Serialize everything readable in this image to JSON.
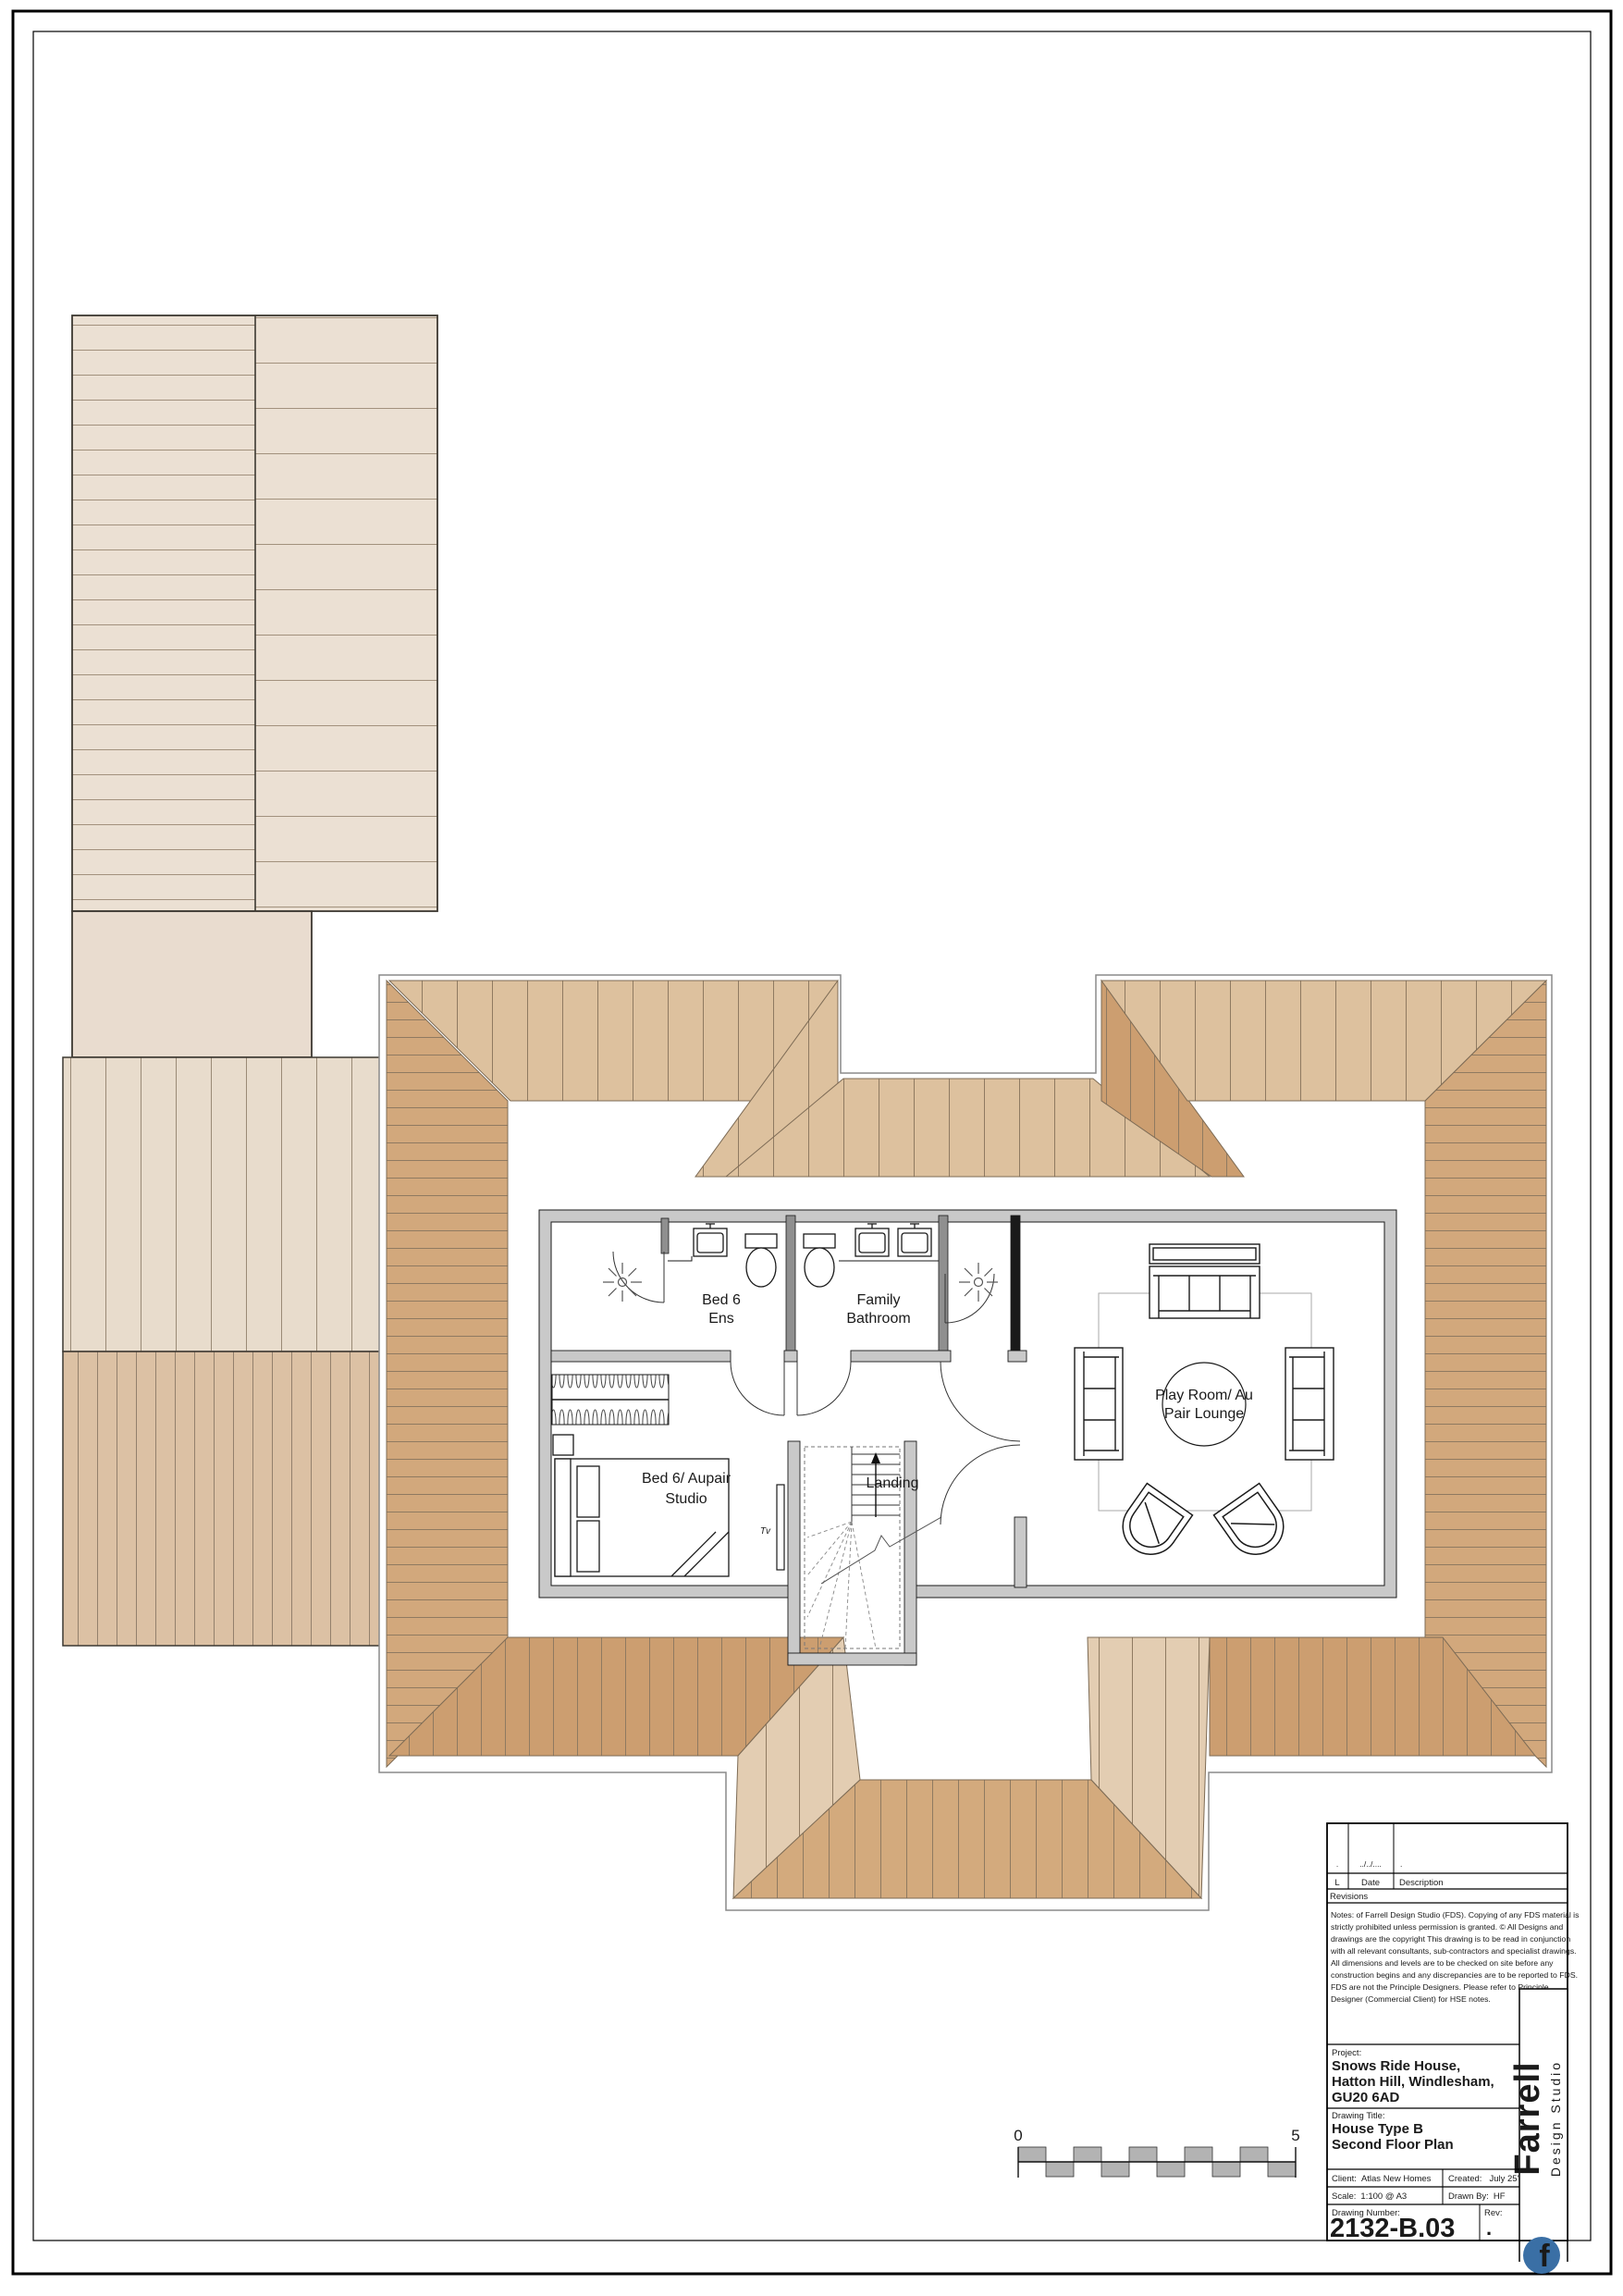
{
  "rooms": {
    "bed6_ens": {
      "lines": [
        "Bed 6",
        "Ens"
      ]
    },
    "family_bathroom": {
      "lines": [
        "Family",
        "Bathroom"
      ]
    },
    "landing": {
      "label": "Landing"
    },
    "bed6_aupair": {
      "lines": [
        "Bed 6/ Aupair",
        "Studio"
      ]
    },
    "playroom": {
      "lines": [
        "Play Room/ Au",
        "Pair Lounge"
      ]
    },
    "tv_label": "Tv"
  },
  "scale_bar": {
    "start": "0",
    "end": "5"
  },
  "title_block": {
    "revisions": {
      "empty_l": ".",
      "empty_date": "../../....",
      "empty_desc": ".",
      "col_l": "L",
      "col_date": "Date",
      "col_desc": "Description",
      "row_label": "Revisions"
    },
    "notes_lines": [
      "Notes: of Farrell Design Studio (FDS). Copying of any FDS material is",
      "strictly prohibited unless permission is granted.  © All Designs and",
      "drawings are the copyright This drawing is to be read in conjunction",
      "with all relevant consultants, sub-contractors and specialist drawings.",
      "All dimensions and levels are to be checked on site before any",
      "construction begins and any discrepancies are to be reported to FDS.",
      "FDS are not the Principle Designers. Please refer to Principle",
      "Designer (Commercial Client) for HSE notes."
    ],
    "project": {
      "label": "Project:",
      "lines": [
        "Snows Ride House,",
        "Hatton Hill, Windlesham,",
        "GU20 6AD"
      ]
    },
    "drawing_title": {
      "label": "Drawing Title:",
      "lines": [
        "House Type B",
        "Second Floor Plan"
      ]
    },
    "client": {
      "label": "Client:",
      "value": "Atlas New Homes"
    },
    "created": {
      "label": "Created:",
      "value": "July 25'"
    },
    "scale": {
      "label": "Scale:",
      "value": "1:100 @ A3"
    },
    "drawn_by": {
      "label": "Drawn By:",
      "value": "HF"
    },
    "drawing_number": {
      "label": "Drawing Number:",
      "value": "2132-B.03"
    },
    "rev": {
      "label": "Rev:",
      "value": "."
    },
    "brand": {
      "name": "Farrell",
      "suffix": "Design Studio",
      "logo_letter": "f"
    }
  },
  "colors": {
    "roof_cream": "#ebe0d3",
    "roof_light": "#ddc19e",
    "roof_medium": "#d2a87c",
    "roof_dark": "#cc9e70",
    "left_light_stripe": "#e8dccc",
    "left_dark_stripe": "#dcc1a4",
    "wall_gray": "#c9c9c9",
    "scalebar_gray": "#b3b3b3",
    "logo_blue": "#3a6fa5"
  }
}
